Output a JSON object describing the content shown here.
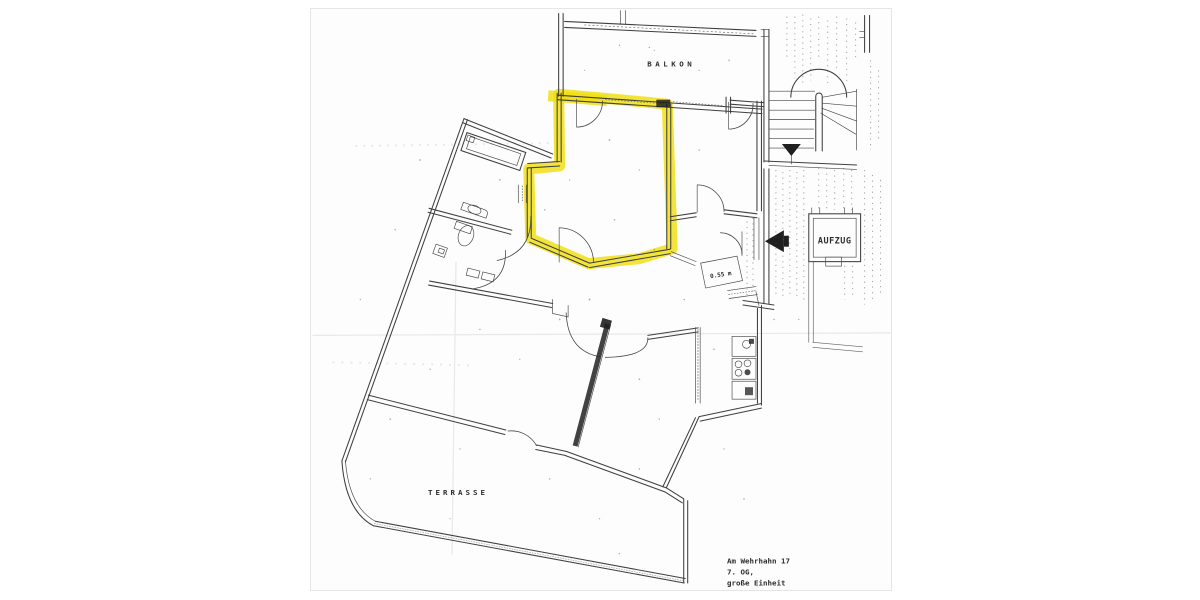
{
  "plan": {
    "labels": {
      "balcony": "BALKON",
      "elevator": "AUFZUG",
      "terrace": "TERRASSE"
    },
    "annotations": {
      "door_width": "0.55 m"
    },
    "title_block": {
      "line1": "Am Wehrhahn 17",
      "line2": "7. OG,",
      "line3": "große Einheit"
    },
    "colors": {
      "highlight": "#f0de10",
      "ink": "#3f3f3f",
      "paper": "#fdfdfd",
      "page_background": "#ffffff"
    }
  }
}
